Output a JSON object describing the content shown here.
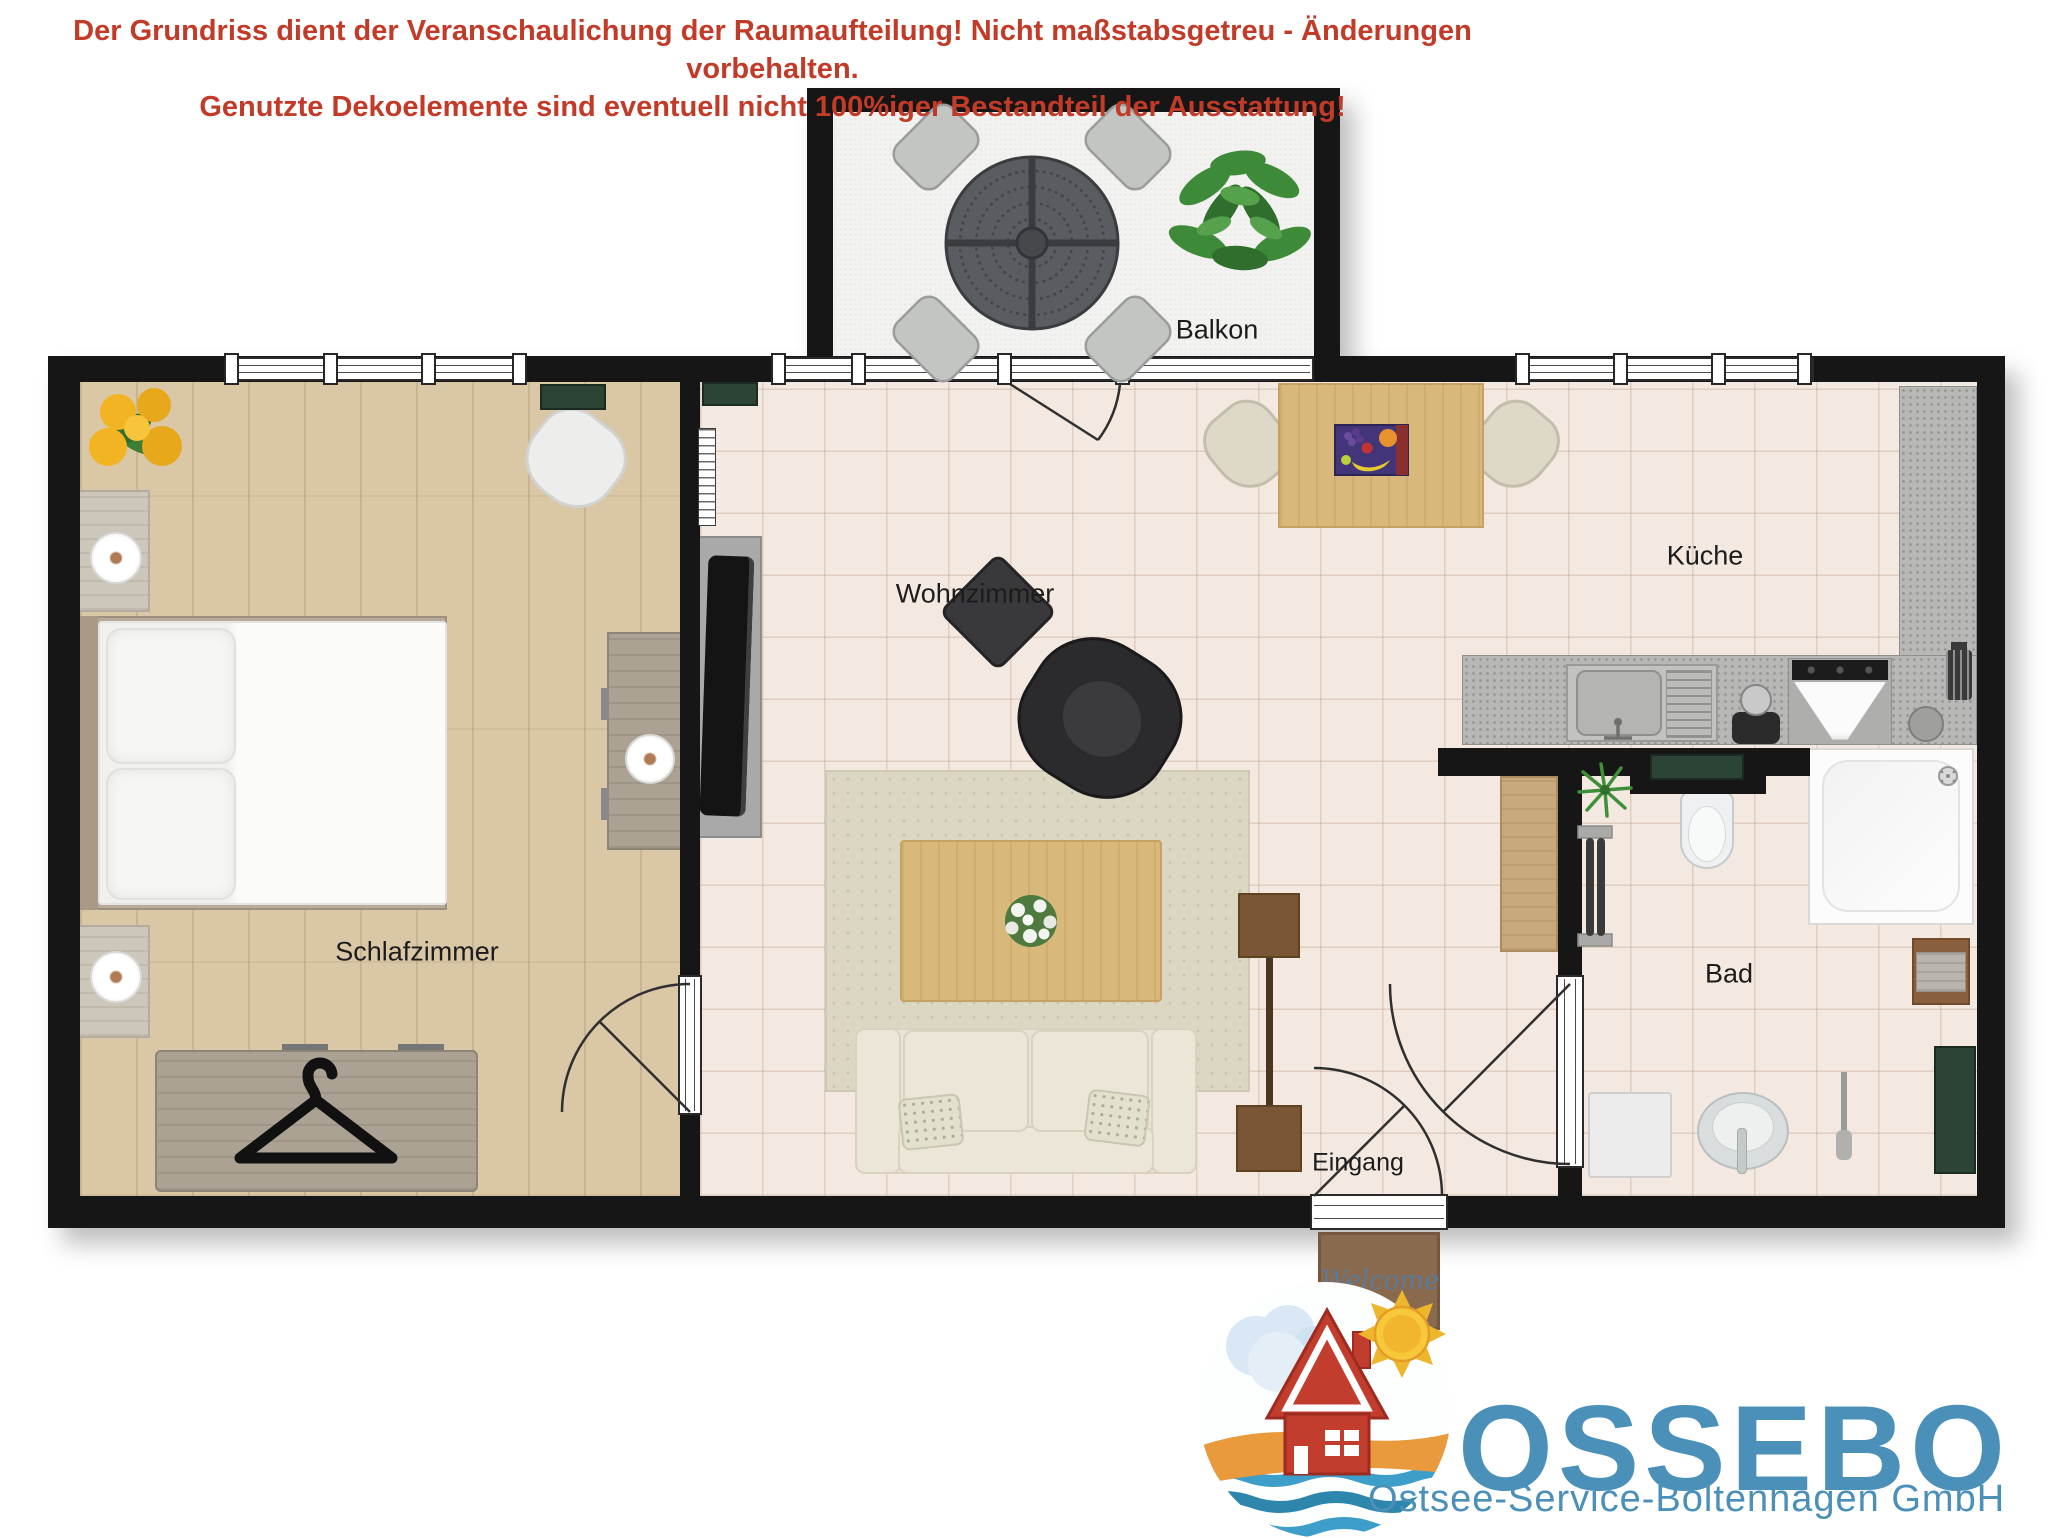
{
  "disclaimer": {
    "line1": "Der Grundriss dient der Veranschaulichung der Raumaufteilung! Nicht maßstabsgetreu - Änderungen vorbehalten.",
    "line2": "Genutzte Dekoelemente sind eventuell nicht 100%iger Bestandteil der Ausstattung!",
    "color": "#c23a28"
  },
  "rooms": {
    "balcony": {
      "label": "Balkon"
    },
    "living": {
      "label": "Wohnzimmer"
    },
    "kitchen": {
      "label": "Küche"
    },
    "bedroom": {
      "label": "Schlafzimmer"
    },
    "bath": {
      "label": "Bad"
    },
    "entrance": {
      "label": "Eingang"
    }
  },
  "doormat": {
    "text": "Welcome"
  },
  "logo": {
    "brand": "OSSEBO",
    "subtitle": "Ostsee-Service-Boltenhagen GmbH",
    "colors": {
      "text": "#4a90b8",
      "house": "#c33d2e",
      "sun": "#f5c52e",
      "beach": "#e89a3c",
      "sea": "#3c9ec9",
      "cloud": "#d9e8f4"
    }
  },
  "colors": {
    "wall": "#161616",
    "accent_red": "#c23a28",
    "wood_floor": "#d9c7a6",
    "tile_floor": "#f4e9e0",
    "balcony_floor": "#f2f2f0",
    "granite": "#b7b8b6",
    "dark_green": "#2c4435",
    "rug": "#dcd7c3",
    "sofa": "#e9e3d6",
    "table_wood": "#d9b87c"
  },
  "icons": {
    "hanger-icon": "clothes hanger",
    "shower-head-icon": "shower head",
    "sun-icon": "sun",
    "cloud-icon": "cloud",
    "house-icon": "house",
    "wave-icon": "waves",
    "plant-icon": "green plant",
    "flower-icon": "flower bouquet",
    "fruit-picture-icon": "fruit still life"
  }
}
